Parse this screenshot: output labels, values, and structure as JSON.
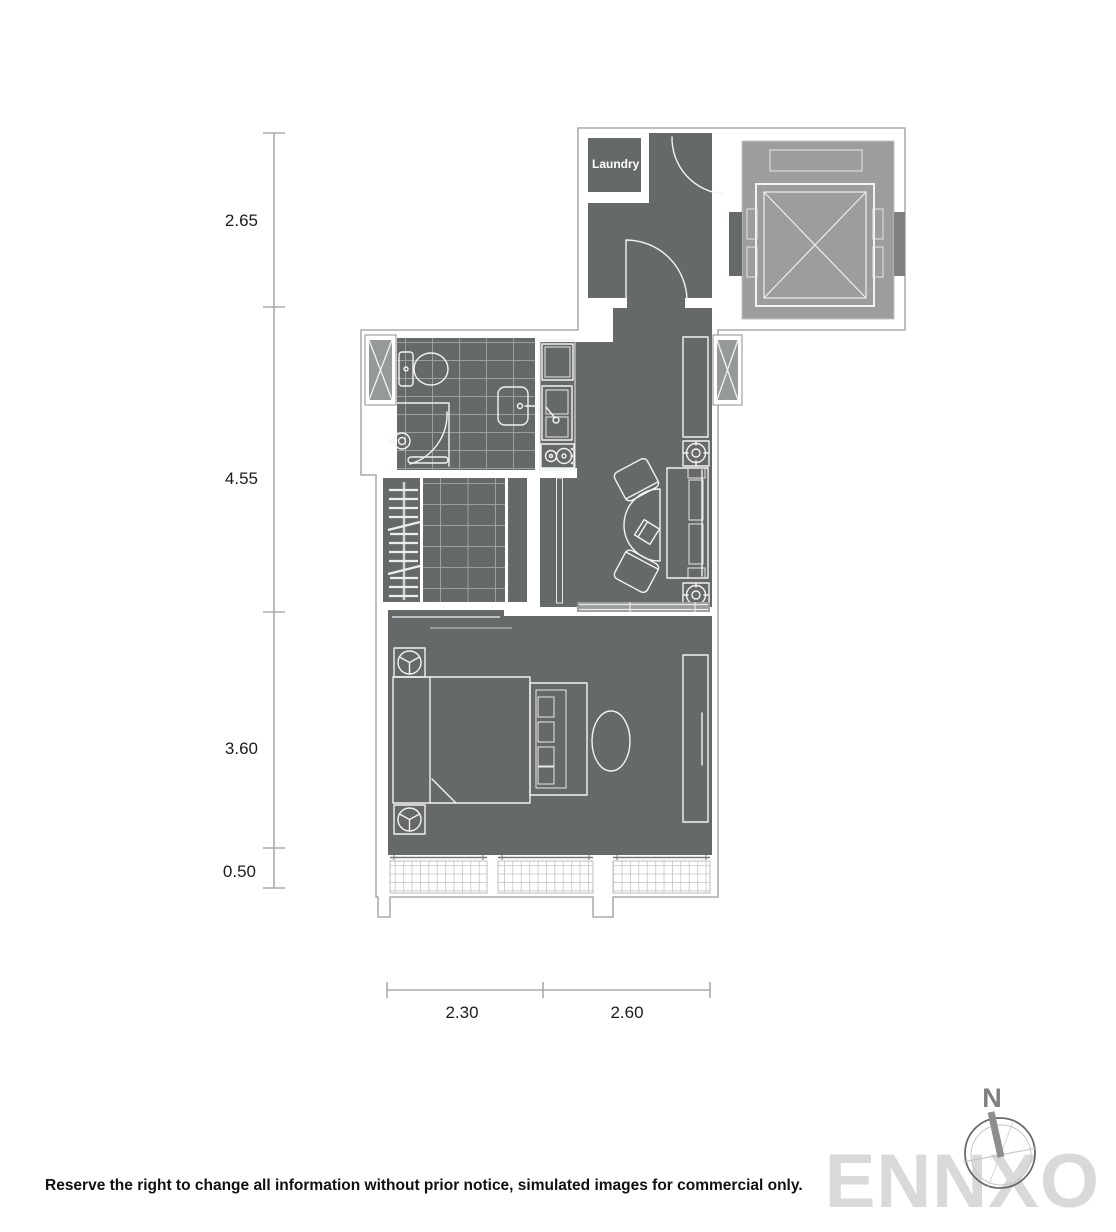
{
  "floor_plan": {
    "rooms": {
      "laundry": "Laundry"
    },
    "dimensions_vertical": [
      {
        "label": "2.65"
      },
      {
        "label": "4.55"
      },
      {
        "label": "3.60"
      },
      {
        "label": "0.50"
      }
    ],
    "dimensions_horizontal": [
      {
        "label": "2.30"
      },
      {
        "label": "2.60"
      }
    ],
    "compass": {
      "north": "N"
    },
    "watermark": "ENNXO",
    "disclaimer": "Reserve the right to change all information without prior notice, simulated images for commercial only.",
    "colors": {
      "floor": "#66696a",
      "elevator_shaft": "#9b9d9e",
      "furniture_line": "#f2f3f3",
      "dimension_line": "#ababab",
      "watermark_gray": "#d9d9d9"
    }
  }
}
